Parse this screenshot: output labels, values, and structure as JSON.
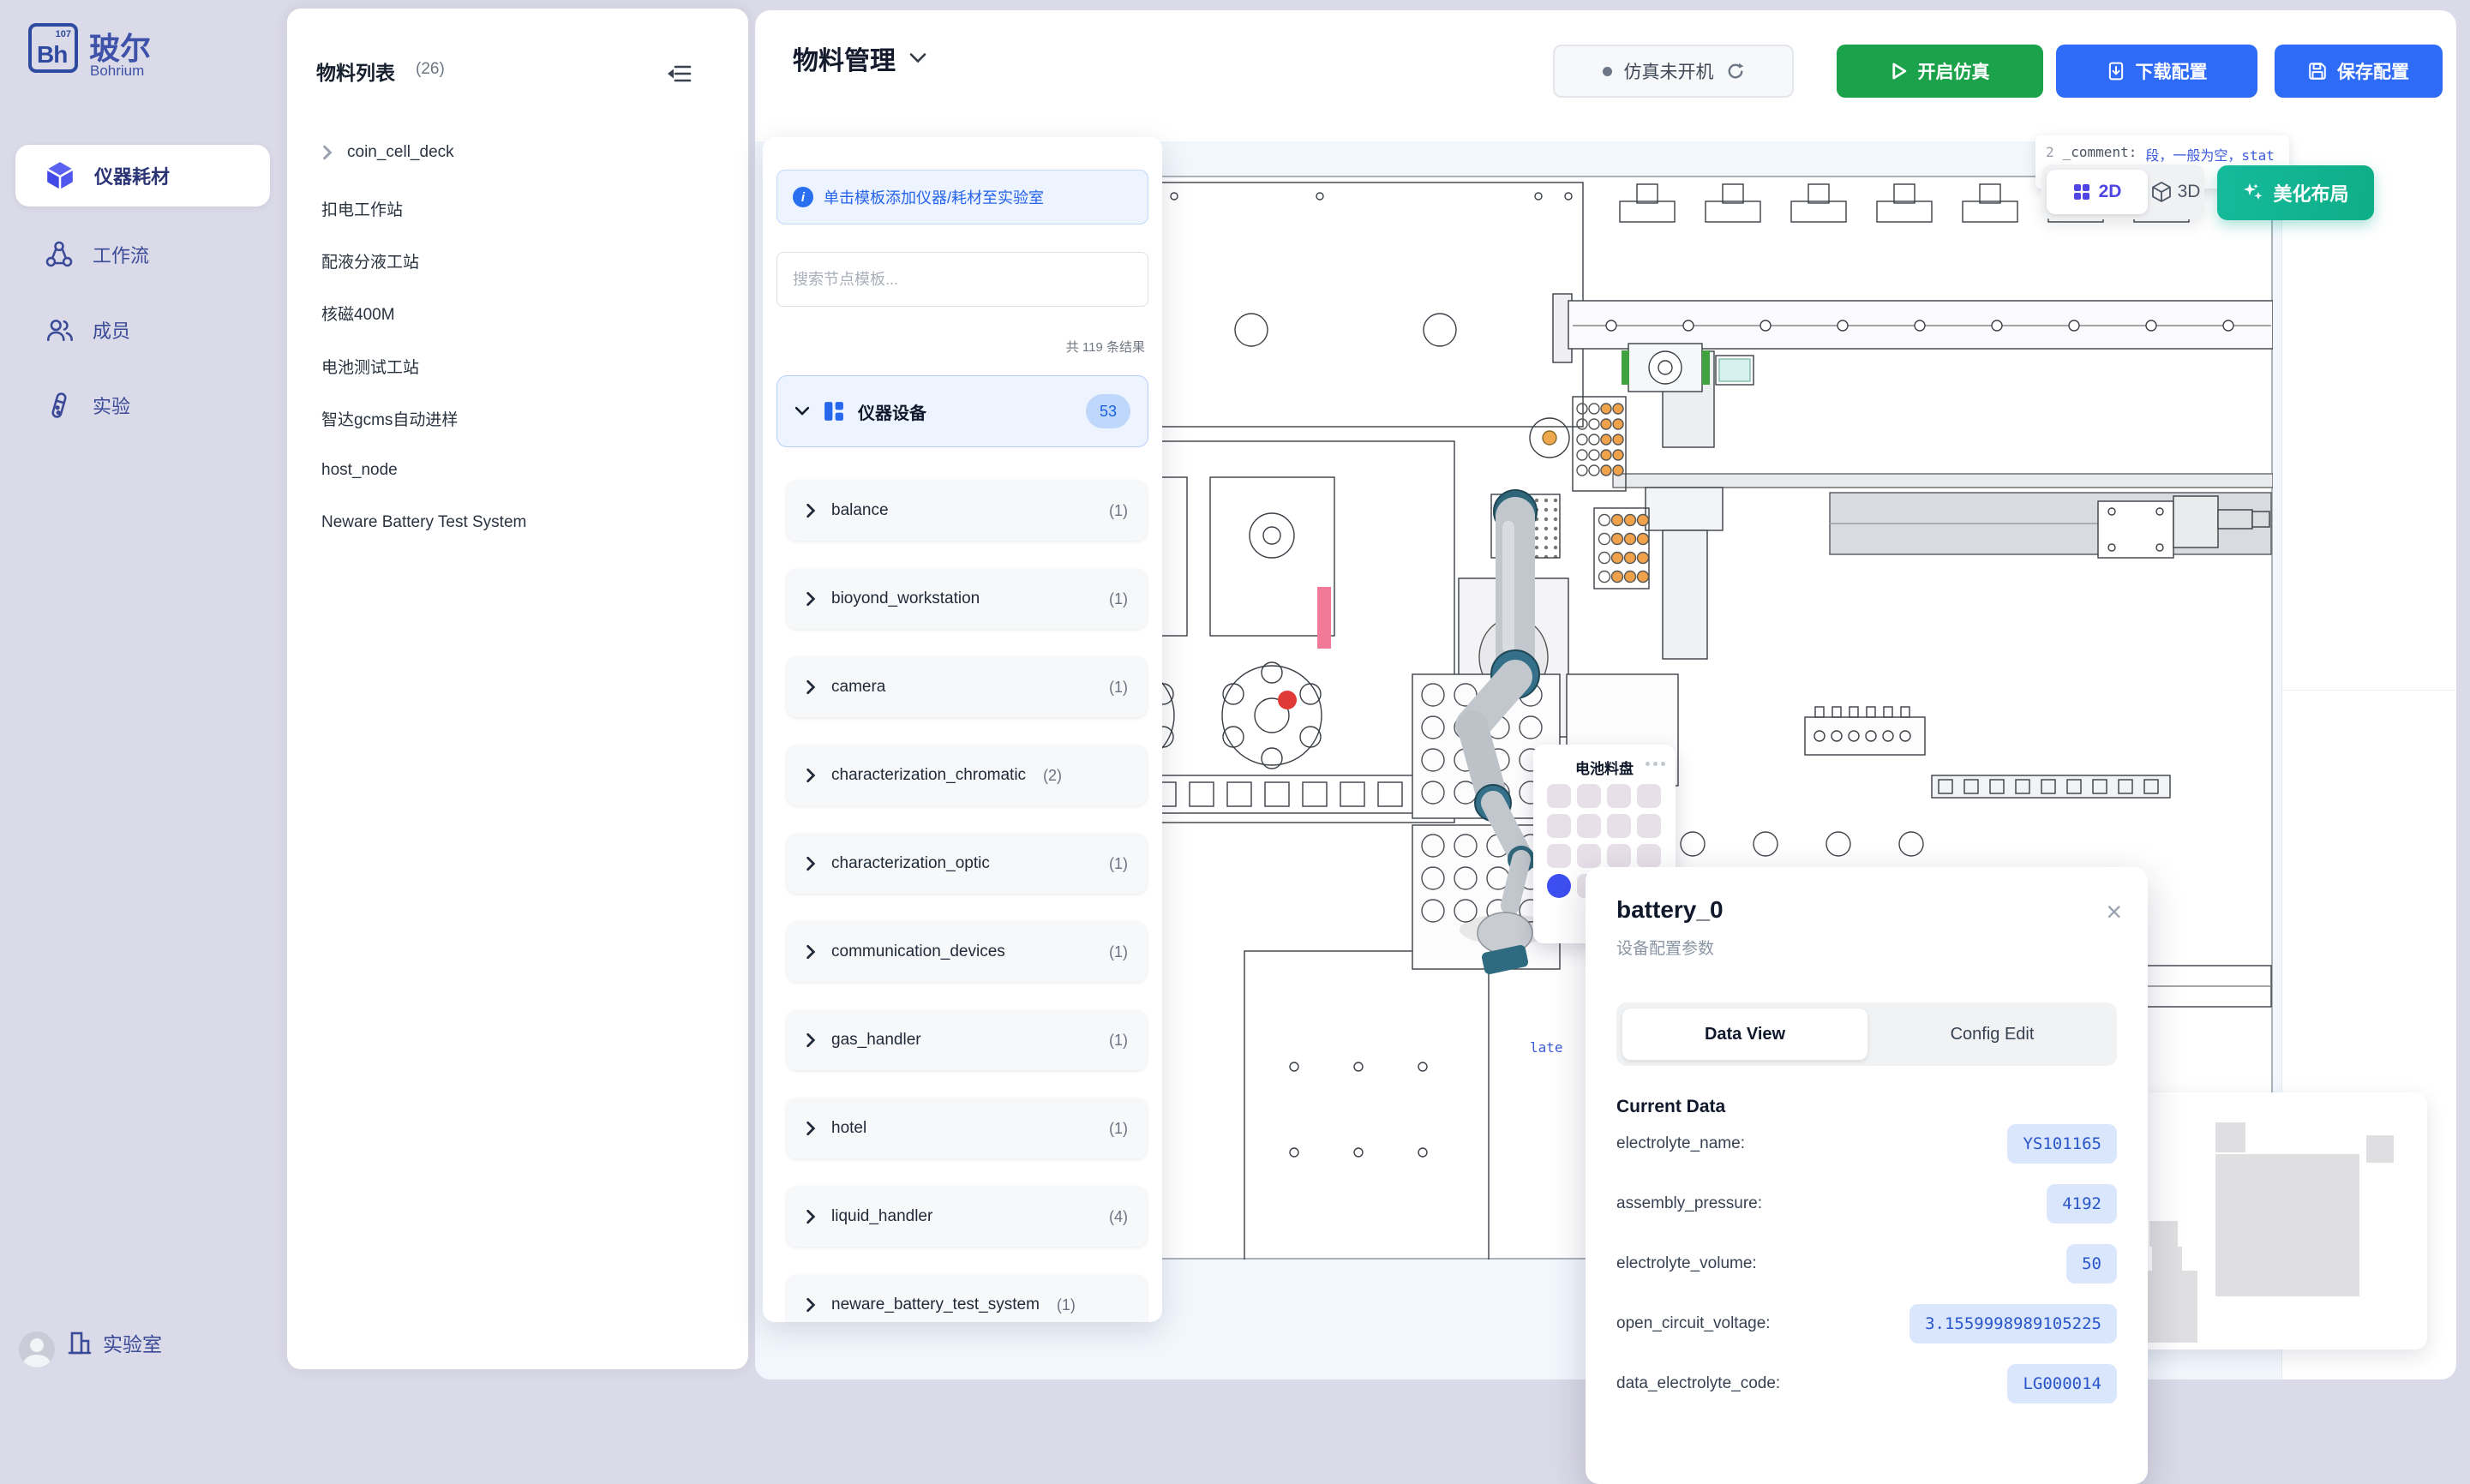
{
  "app": {
    "logo_symbol": "Bh",
    "logo_number": "107",
    "brand_cn": "玻尔",
    "brand_en": "Bohrium"
  },
  "sidebar": {
    "items": [
      {
        "label": "仪器耗材",
        "active": true
      },
      {
        "label": "工作流"
      },
      {
        "label": "成员"
      },
      {
        "label": "实验"
      }
    ],
    "footer_label": "实验室"
  },
  "materials": {
    "title": "物料列表",
    "count": "(26)",
    "items": [
      "coin_cell_deck",
      "扣电工作站",
      "配液分液工站",
      "核磁400M",
      "电池测试工站",
      "智达gcms自动进样",
      "host_node",
      "Neware Battery Test System"
    ]
  },
  "header": {
    "title": "物料管理",
    "status_label": "仿真未开机",
    "start_label": "开启仿真",
    "download_label": "下载配置",
    "save_label": "保存配置"
  },
  "tpl": {
    "banner": "单击模板添加仪器/耗材至实验室",
    "search_placeholder": "搜索节点模板...",
    "results": "共 119 条结果",
    "group_label": "仪器设备",
    "group_badge": "53",
    "items": [
      {
        "label": "balance",
        "count": "(1)"
      },
      {
        "label": "bioyond_workstation",
        "count": "(1)"
      },
      {
        "label": "camera",
        "count": "(1)"
      },
      {
        "label": "characterization_chromatic",
        "count": "(2)"
      },
      {
        "label": "characterization_optic",
        "count": "(1)"
      },
      {
        "label": "communication_devices",
        "count": "(1)"
      },
      {
        "label": "gas_handler",
        "count": "(1)"
      },
      {
        "label": "hotel",
        "count": "(1)"
      },
      {
        "label": "liquid_handler",
        "count": "(4)"
      },
      {
        "label": "neware_battery_test_system",
        "count": "(1)"
      }
    ]
  },
  "canvas": {
    "code_no": "2",
    "code_key": "_comment:",
    "code_val": "段，一般为空，stat",
    "view2d": "2D",
    "view3d": "3D",
    "beautify": "美化布局",
    "fragment_right": "esou",
    "type_label": "type: Coi",
    "plate_label": "late",
    "tray_title": "电池料盘"
  },
  "popup": {
    "title": "battery_0",
    "subtitle": "设备配置参数",
    "tab_data": "Data View",
    "tab_config": "Config Edit",
    "section": "Current Data",
    "rows": [
      {
        "label": "electrolyte_name:",
        "value": "YS101165"
      },
      {
        "label": "assembly_pressure:",
        "value": "4192"
      },
      {
        "label": "electrolyte_volume:",
        "value": "50"
      },
      {
        "label": "open_circuit_voltage:",
        "value": "3.1559998989105225"
      },
      {
        "label": "data_electrolyte_code:",
        "value": "LG000014"
      }
    ]
  },
  "colors": {
    "accent_blue": "#2E6BF6",
    "green": "#1CA24A",
    "teal": "#10B392",
    "indigo": "#4F46E5",
    "value_blue": "#2A56CC",
    "sidebar_bg": "#DBDAE8"
  }
}
